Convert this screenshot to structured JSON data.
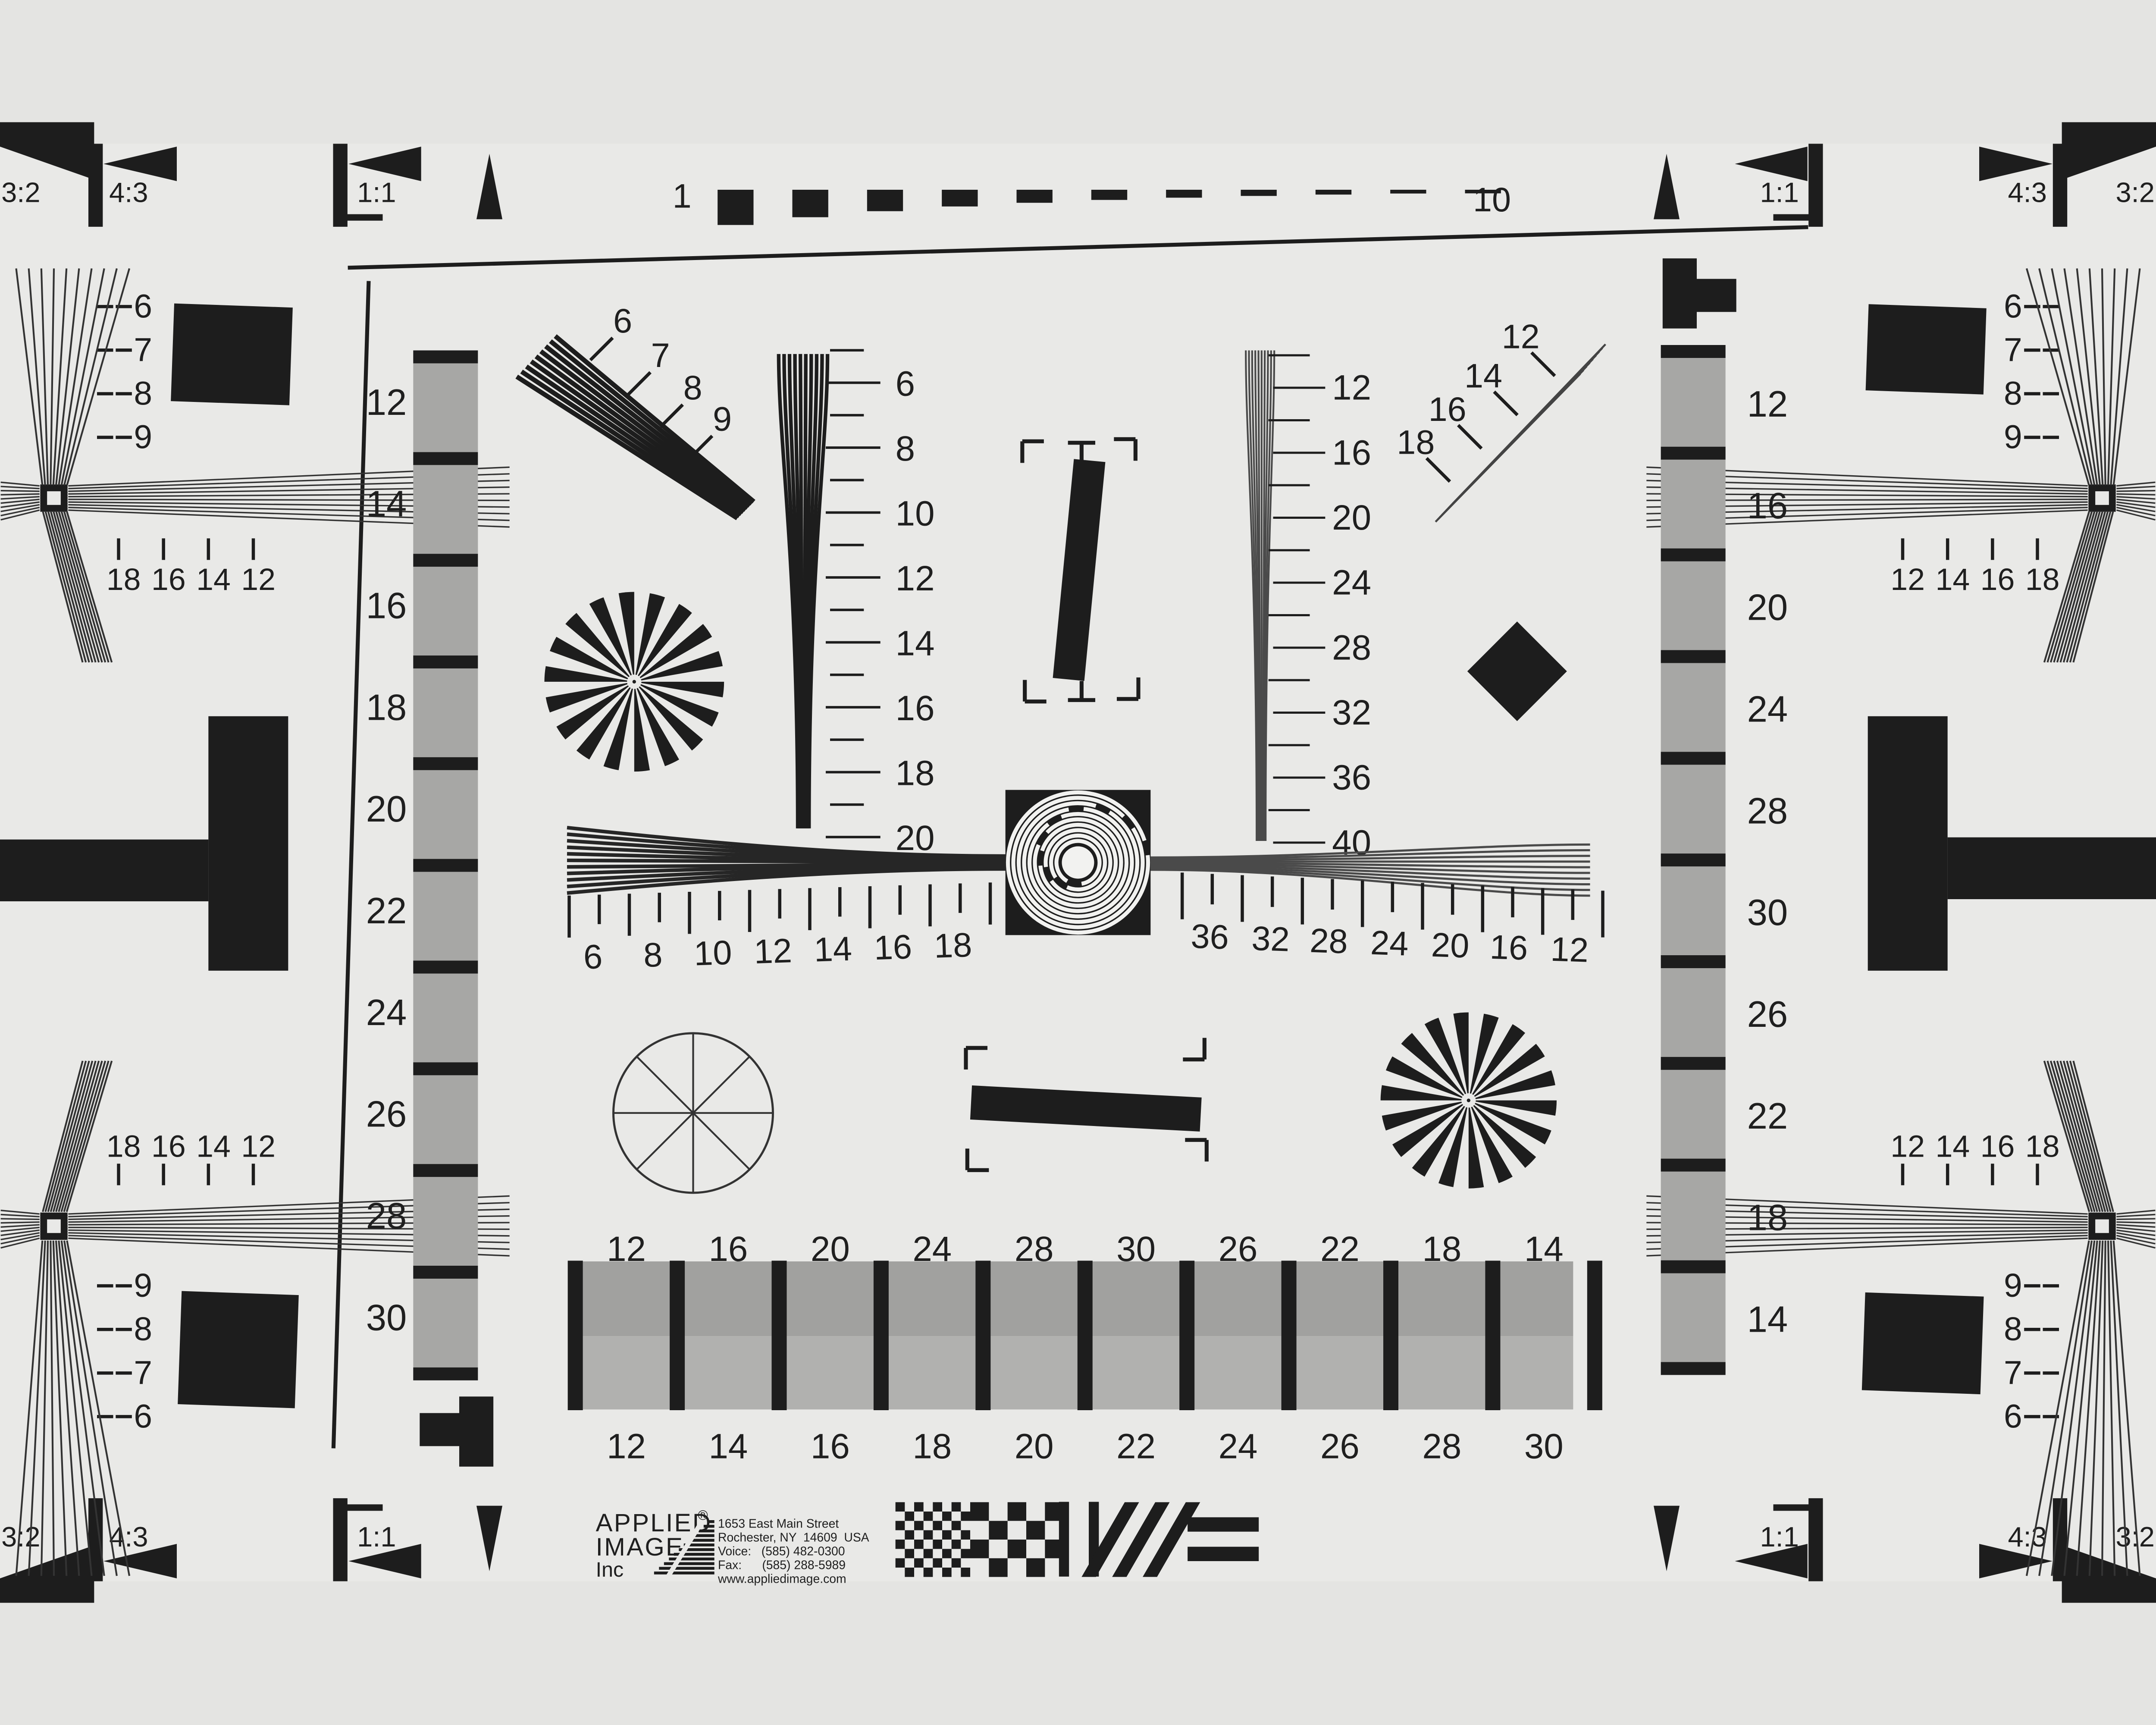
{
  "background": "#e9e9e7",
  "ink": "#1d1d1d",
  "gray_step": "#a7a7a5",
  "gray_top_row": "#a1a19f",
  "gray_bottom_row": "#b1b1af",
  "aspect_labels": [
    "3:2",
    "4:3",
    "1:1"
  ],
  "top_ruler": {
    "left": "1",
    "right": "10"
  },
  "corner_cluster": {
    "wedge_numbers": [
      "6",
      "7",
      "8",
      "9"
    ],
    "tick_numbers": [
      "18",
      "16",
      "14",
      "12"
    ]
  },
  "columns": {
    "left": [
      "12",
      "14",
      "16",
      "18",
      "20",
      "22",
      "24",
      "26",
      "28",
      "30"
    ],
    "right": [
      "12",
      "16",
      "20",
      "24",
      "28",
      "30",
      "26",
      "22",
      "18",
      "14"
    ]
  },
  "vertical_wedges": {
    "left": [
      "6",
      "8",
      "10",
      "12",
      "14",
      "16",
      "18",
      "20"
    ],
    "right": [
      "12",
      "16",
      "20",
      "24",
      "28",
      "32",
      "36",
      "40"
    ]
  },
  "horizontal_rulers": {
    "left": [
      "6",
      "8",
      "10",
      "12",
      "14",
      "16",
      "18"
    ],
    "right": [
      "36",
      "32",
      "28",
      "24",
      "20",
      "16",
      "12"
    ]
  },
  "diagonal_wedges": {
    "left": [
      "6",
      "7",
      "8",
      "9"
    ],
    "right": [
      "12",
      "14",
      "16",
      "18"
    ]
  },
  "bottom_bar": {
    "top": [
      "12",
      "16",
      "20",
      "24",
      "28",
      "30",
      "26",
      "22",
      "18",
      "14"
    ],
    "bottom": [
      "12",
      "14",
      "16",
      "18",
      "20",
      "22",
      "24",
      "26",
      "28",
      "30"
    ]
  },
  "logo": {
    "line1": "APPLIED",
    "registered": "®",
    "line2": "IMAGE",
    "line3": "Inc",
    "address": [
      "1653 East Main Street",
      "Rochester, NY  14609  USA",
      "Voice:   (585) 482-0300",
      "Fax:      (585) 288-5989",
      "www.appliedimage.com"
    ]
  }
}
